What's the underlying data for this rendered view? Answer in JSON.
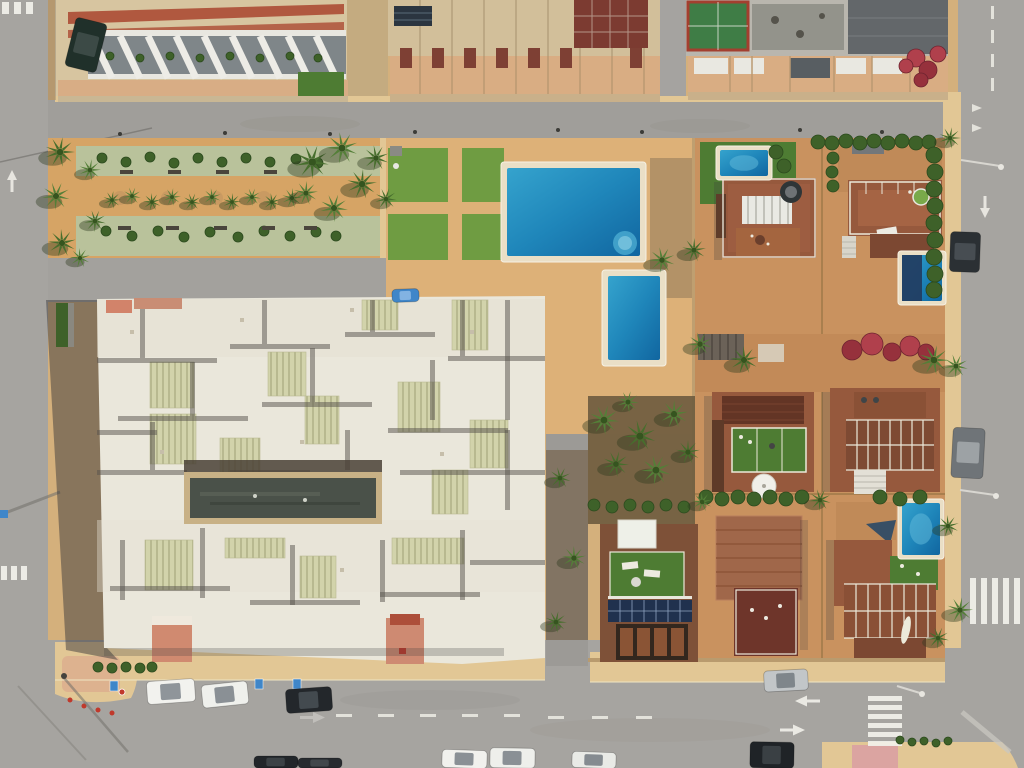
{
  "meta": {
    "description": "Aerial top-down drone view of a sunny coastal residential neighborhood: apartment blocks at top, a linear palm park, a community pool area, a large white apartment complex with a dark central atrium, terracotta villa plots with roof terraces and plunge pools, perimeter roads with zebra crossings and parked cars"
  },
  "palette": {
    "sand_base": "#d4b07c",
    "sand_park": "#d6a465",
    "sand_deck": "#ddb178",
    "sand_sidewalk": "#e2c795",
    "road": "#a6a4a0",
    "road_light": "#b0aeaa",
    "road_dark": "#8f8d89",
    "white_roof": "#eae7db",
    "white_ridge": "#f7f4ea",
    "roof_shadow": "#55524b",
    "skylight": "#d2d3ab",
    "atrium": "#4a5149",
    "atrium_frame": "#c8b186",
    "beige_roof": "#d7c5a0",
    "beige_roof2": "#d2bf9a",
    "terracotta": "#b0583f",
    "maroon_roof": "#7c3b31",
    "terrace": "#d9ad83",
    "grey_roof": "#63676a",
    "grey_patio": "#93938b",
    "villa_roof": "#96593d",
    "villa_roof_dark": "#6e352a",
    "patio": "#c9925f",
    "lawn": "#6f9c42",
    "turf": "#4e7c33",
    "park_green": "#b9c29b",
    "hedge": "#3e6129",
    "palm": "#4f7d36",
    "pool_blue": "#1f86ba",
    "pool_light": "#5fb8d8",
    "pool_rim": "#eadfc6",
    "pool_cover": "#223e63",
    "car_white": "#f2f2ee",
    "car_dark": "#23272b",
    "car_silver": "#c2c6c8",
    "car_blue": "#3f86c9",
    "salmon": "#d08a70",
    "pink_paving": "#daa0a2",
    "solar_panel": "#20314e",
    "marking_white": "#f2f1ea"
  },
  "counts": {
    "pools": 5,
    "cars": 14,
    "palm_trees": 45,
    "benches": 9,
    "zebra_crossings": 4
  },
  "areas": [
    "apartment buildings (top edge)",
    "linear palm park with green planting beds",
    "community lawn and main pool",
    "secondary pool",
    "white apartment complex with central atrium courtyard",
    "villa plots with roof terraces",
    "villa with rooftop solar panels",
    "perimeter roads",
    "bottom parking road with cars",
    "zebra crossings"
  ],
  "scene": {
    "pools": [
      {
        "name": "main-community-pool",
        "x": 507,
        "y": 168,
        "w": 133,
        "h": 88,
        "rim": 6,
        "steps": true
      },
      {
        "name": "secondary-pool",
        "x": 608,
        "y": 276,
        "w": 52,
        "h": 84,
        "rim": 6
      },
      {
        "name": "villa-plunge-pool",
        "x": 720,
        "y": 150,
        "w": 48,
        "h": 26,
        "rim": 4,
        "light": true
      },
      {
        "name": "villa-pool-covered",
        "x": 902,
        "y": 255,
        "w": 40,
        "h": 46,
        "rim": 4,
        "cover": true
      },
      {
        "name": "villa-pool-row3",
        "x": 902,
        "y": 503,
        "w": 38,
        "h": 52,
        "rim": 4,
        "light": true
      }
    ],
    "palms": [
      [
        60,
        152,
        15
      ],
      [
        56,
        196,
        14
      ],
      [
        62,
        243,
        14
      ],
      [
        90,
        170,
        11
      ],
      [
        95,
        221,
        11
      ],
      [
        80,
        258,
        10
      ],
      [
        112,
        200,
        9
      ],
      [
        132,
        196,
        9
      ],
      [
        152,
        202,
        9
      ],
      [
        172,
        197,
        9
      ],
      [
        192,
        202,
        9
      ],
      [
        212,
        197,
        9
      ],
      [
        232,
        202,
        9
      ],
      [
        252,
        197,
        9
      ],
      [
        272,
        202,
        9
      ],
      [
        292,
        198,
        10
      ],
      [
        312,
        162,
        17
      ],
      [
        342,
        148,
        16
      ],
      [
        362,
        184,
        15
      ],
      [
        334,
        208,
        14
      ],
      [
        376,
        158,
        13
      ],
      [
        306,
        193,
        12
      ],
      [
        386,
        199,
        11
      ],
      [
        662,
        260,
        13
      ],
      [
        694,
        250,
        12
      ],
      [
        604,
        420,
        15
      ],
      [
        640,
        436,
        16
      ],
      [
        674,
        414,
        14
      ],
      [
        616,
        464,
        13
      ],
      [
        656,
        470,
        15
      ],
      [
        688,
        452,
        12
      ],
      [
        628,
        402,
        11
      ],
      [
        560,
        478,
        11
      ],
      [
        574,
        558,
        12
      ],
      [
        556,
        622,
        11
      ],
      [
        700,
        344,
        12
      ],
      [
        744,
        360,
        14
      ],
      [
        934,
        360,
        15
      ],
      [
        820,
        500,
        11
      ],
      [
        702,
        502,
        10
      ],
      [
        950,
        138,
        11
      ],
      [
        956,
        366,
        12
      ],
      [
        948,
        526,
        11
      ],
      [
        960,
        610,
        13
      ],
      [
        938,
        638,
        11
      ]
    ],
    "bushes": [
      [
        102,
        158,
        5
      ],
      [
        126,
        162,
        5
      ],
      [
        150,
        157,
        5
      ],
      [
        174,
        163,
        5
      ],
      [
        198,
        158,
        5
      ],
      [
        222,
        162,
        5
      ],
      [
        246,
        158,
        5
      ],
      [
        270,
        162,
        5
      ],
      [
        296,
        159,
        5
      ],
      [
        318,
        163,
        5
      ],
      [
        106,
        231,
        5
      ],
      [
        132,
        236,
        5
      ],
      [
        158,
        231,
        5
      ],
      [
        184,
        237,
        5
      ],
      [
        210,
        232,
        5
      ],
      [
        238,
        237,
        5
      ],
      [
        264,
        231,
        5
      ],
      [
        290,
        236,
        5
      ],
      [
        316,
        232,
        5
      ],
      [
        336,
        236,
        5
      ],
      [
        818,
        142,
        7
      ],
      [
        832,
        143,
        7
      ],
      [
        846,
        141,
        7
      ],
      [
        860,
        143,
        7
      ],
      [
        874,
        141,
        7
      ],
      [
        888,
        143,
        7
      ],
      [
        902,
        141,
        7
      ],
      [
        916,
        143,
        7
      ],
      [
        929,
        142,
        7
      ],
      [
        934,
        155,
        8
      ],
      [
        935,
        172,
        8
      ],
      [
        934,
        189,
        8
      ],
      [
        935,
        206,
        8
      ],
      [
        934,
        223,
        8
      ],
      [
        935,
        240,
        8
      ],
      [
        934,
        257,
        8
      ],
      [
        935,
        274,
        8
      ],
      [
        934,
        290,
        8
      ],
      [
        706,
        497,
        7
      ],
      [
        722,
        499,
        7
      ],
      [
        738,
        497,
        7
      ],
      [
        754,
        499,
        7
      ],
      [
        770,
        497,
        7
      ],
      [
        786,
        499,
        7
      ],
      [
        802,
        497,
        7
      ],
      [
        880,
        497,
        7
      ],
      [
        900,
        499,
        7
      ],
      [
        920,
        497,
        7
      ],
      [
        98,
        667,
        5
      ],
      [
        112,
        668,
        5
      ],
      [
        126,
        667,
        5
      ],
      [
        140,
        668,
        5
      ],
      [
        152,
        667,
        5
      ],
      [
        900,
        740,
        4
      ],
      [
        912,
        742,
        4
      ],
      [
        924,
        741,
        4
      ],
      [
        936,
        743,
        4
      ],
      [
        948,
        741,
        4
      ],
      [
        110,
        56,
        4
      ],
      [
        140,
        58,
        4
      ],
      [
        170,
        56,
        4
      ],
      [
        200,
        58,
        4
      ],
      [
        230,
        56,
        4
      ],
      [
        260,
        58,
        4
      ],
      [
        290,
        56,
        4
      ],
      [
        318,
        58,
        4
      ],
      [
        833,
        158,
        6
      ],
      [
        832,
        172,
        6
      ],
      [
        833,
        186,
        6
      ],
      [
        776,
        152,
        7
      ],
      [
        784,
        166,
        7
      ],
      [
        594,
        505,
        6
      ],
      [
        612,
        507,
        6
      ],
      [
        630,
        505,
        6
      ],
      [
        648,
        507,
        6
      ],
      [
        666,
        505,
        6
      ],
      [
        684,
        507,
        6
      ]
    ],
    "red_bushes": [
      [
        852,
        350,
        10
      ],
      [
        872,
        344,
        11
      ],
      [
        892,
        352,
        9
      ],
      [
        910,
        346,
        10
      ],
      [
        926,
        352,
        8
      ],
      [
        916,
        58,
        9
      ],
      [
        928,
        70,
        9
      ],
      [
        938,
        54,
        8
      ],
      [
        921,
        80,
        7
      ],
      [
        906,
        66,
        7
      ]
    ],
    "benches": [
      [
        120,
        170
      ],
      [
        168,
        170
      ],
      [
        216,
        170
      ],
      [
        264,
        170
      ],
      [
        118,
        226
      ],
      [
        166,
        226
      ],
      [
        214,
        226
      ],
      [
        262,
        226
      ],
      [
        304,
        226
      ]
    ],
    "crosswalks": [
      {
        "name": "crosswalk-bottom-road",
        "x": 868,
        "y": 696,
        "dir": "stack-y",
        "w": 34,
        "h": 5,
        "count": 6,
        "gap": 4
      },
      {
        "name": "crosswalk-right-road",
        "x": 970,
        "y": 578,
        "dir": "stack-x",
        "w": 6,
        "h": 46,
        "count": 5,
        "gap": 5
      },
      {
        "name": "crosswalk-left-top",
        "x": 2,
        "y": 2,
        "dir": "stack-x",
        "w": 7,
        "h": 12,
        "count": 3,
        "gap": 5
      },
      {
        "name": "crosswalk-left-mid",
        "x": 1,
        "y": 566,
        "dir": "stack-x",
        "w": 6,
        "h": 14,
        "count": 3,
        "gap": 4
      }
    ],
    "lane_dashes": [
      {
        "x": 991,
        "y": 6,
        "w": 3,
        "h": 13,
        "count": 4,
        "step": 24,
        "axis": "y"
      },
      {
        "x": 336,
        "y": 714,
        "w": 16,
        "h": 3,
        "count": 5,
        "step": 42,
        "axis": "x"
      },
      {
        "x": 548,
        "y": 716,
        "w": 16,
        "h": 3,
        "count": 3,
        "step": 44,
        "axis": "x"
      }
    ],
    "cars": [
      {
        "name": "dark-car-left-road",
        "x": 70,
        "y": 20,
        "w": 32,
        "h": 50,
        "rot": 14,
        "body": "#20302a",
        "glass": "#3c4a46"
      },
      {
        "name": "dark-car-right-road",
        "x": 950,
        "y": 232,
        "w": 30,
        "h": 40,
        "rot": 2,
        "body": "#2b3034",
        "glass": "#474d52"
      },
      {
        "name": "grey-car-right-road",
        "x": 952,
        "y": 428,
        "w": 32,
        "h": 50,
        "rot": 3,
        "body": "#6f7478",
        "glass": "#9da2a5"
      },
      {
        "name": "white-van",
        "x": 147,
        "y": 680,
        "w": 48,
        "h": 23,
        "rot": -4,
        "body": "#f2f2ee",
        "glass": "#8f959a"
      },
      {
        "name": "white-car-1",
        "x": 202,
        "y": 683,
        "w": 46,
        "h": 23,
        "rot": -6,
        "body": "#eff0ec",
        "glass": "#8a9095"
      },
      {
        "name": "dark-suv",
        "x": 286,
        "y": 688,
        "w": 46,
        "h": 24,
        "rot": -4,
        "body": "#23272b",
        "glass": "#434a4f"
      },
      {
        "name": "silver-car",
        "x": 764,
        "y": 670,
        "w": 44,
        "h": 21,
        "rot": -3,
        "body": "#c2c6c8",
        "glass": "#7f868b"
      },
      {
        "name": "white-car-2",
        "x": 442,
        "y": 750,
        "w": 45,
        "h": 18,
        "rot": 2,
        "body": "#f1f1ed",
        "glass": "#8a9095"
      },
      {
        "name": "white-car-3",
        "x": 490,
        "y": 748,
        "w": 45,
        "h": 20,
        "rot": 1,
        "body": "#eeefeb",
        "glass": "#8a9095"
      },
      {
        "name": "white-car-4",
        "x": 572,
        "y": 752,
        "w": 44,
        "h": 16,
        "rot": 2,
        "body": "#e9eae6",
        "glass": "#858b90"
      },
      {
        "name": "dark-car-bottom-1",
        "x": 254,
        "y": 756,
        "w": 44,
        "h": 12,
        "rot": 0,
        "body": "#22262a",
        "glass": "#3c4246"
      },
      {
        "name": "dark-car-bottom-2",
        "x": 298,
        "y": 758,
        "w": 44,
        "h": 10,
        "rot": 0,
        "body": "#272b2f",
        "glass": "#41474b"
      },
      {
        "name": "dark-car-bottom-3",
        "x": 750,
        "y": 742,
        "w": 44,
        "h": 26,
        "rot": 1,
        "body": "#1f2327",
        "glass": "#3a4044"
      },
      {
        "name": "blue-car-street",
        "x": 392,
        "y": 289,
        "w": 27,
        "h": 13,
        "rot": -2,
        "body": "#3f86c9",
        "glass": "#82b3e2"
      }
    ],
    "complex": {
      "seams": [
        [
          97,
          358,
          120,
          5
        ],
        [
          230,
          344,
          100,
          5
        ],
        [
          345,
          332,
          90,
          5
        ],
        [
          448,
          356,
          97,
          5
        ],
        [
          140,
          306,
          5,
          52
        ],
        [
          262,
          300,
          5,
          44
        ],
        [
          370,
          300,
          5,
          32
        ],
        [
          460,
          300,
          5,
          56
        ],
        [
          118,
          416,
          130,
          5
        ],
        [
          262,
          402,
          110,
          5
        ],
        [
          388,
          428,
          120,
          5
        ],
        [
          190,
          362,
          5,
          54
        ],
        [
          310,
          348,
          5,
          54
        ],
        [
          430,
          360,
          5,
          60
        ],
        [
          505,
          300,
          5,
          120
        ],
        [
          97,
          470,
          90,
          5
        ],
        [
          400,
          470,
          145,
          5
        ],
        [
          150,
          422,
          5,
          48
        ],
        [
          345,
          430,
          5,
          40
        ],
        [
          120,
          540,
          5,
          60
        ],
        [
          200,
          528,
          5,
          70
        ],
        [
          290,
          545,
          5,
          60
        ],
        [
          380,
          540,
          5,
          62
        ],
        [
          460,
          530,
          5,
          70
        ],
        [
          110,
          586,
          120,
          5
        ],
        [
          250,
          600,
          110,
          5
        ],
        [
          380,
          592,
          100,
          5
        ],
        [
          470,
          560,
          75,
          5
        ],
        [
          505,
          430,
          5,
          80
        ],
        [
          97,
          430,
          60,
          5
        ],
        [
          230,
          470,
          80,
          5
        ]
      ],
      "skylights": [
        [
          150,
          362,
          44,
          46
        ],
        [
          150,
          414,
          46,
          50
        ],
        [
          220,
          438,
          40,
          50
        ],
        [
          268,
          352,
          38,
          44
        ],
        [
          305,
          396,
          34,
          48
        ],
        [
          362,
          300,
          36,
          30
        ],
        [
          398,
          382,
          42,
          50
        ],
        [
          452,
          300,
          36,
          50
        ],
        [
          470,
          420,
          38,
          48
        ],
        [
          145,
          540,
          48,
          50
        ],
        [
          225,
          538,
          60,
          20
        ],
        [
          392,
          538,
          72,
          26
        ],
        [
          300,
          556,
          36,
          42
        ],
        [
          432,
          470,
          36,
          44
        ]
      ]
    }
  }
}
